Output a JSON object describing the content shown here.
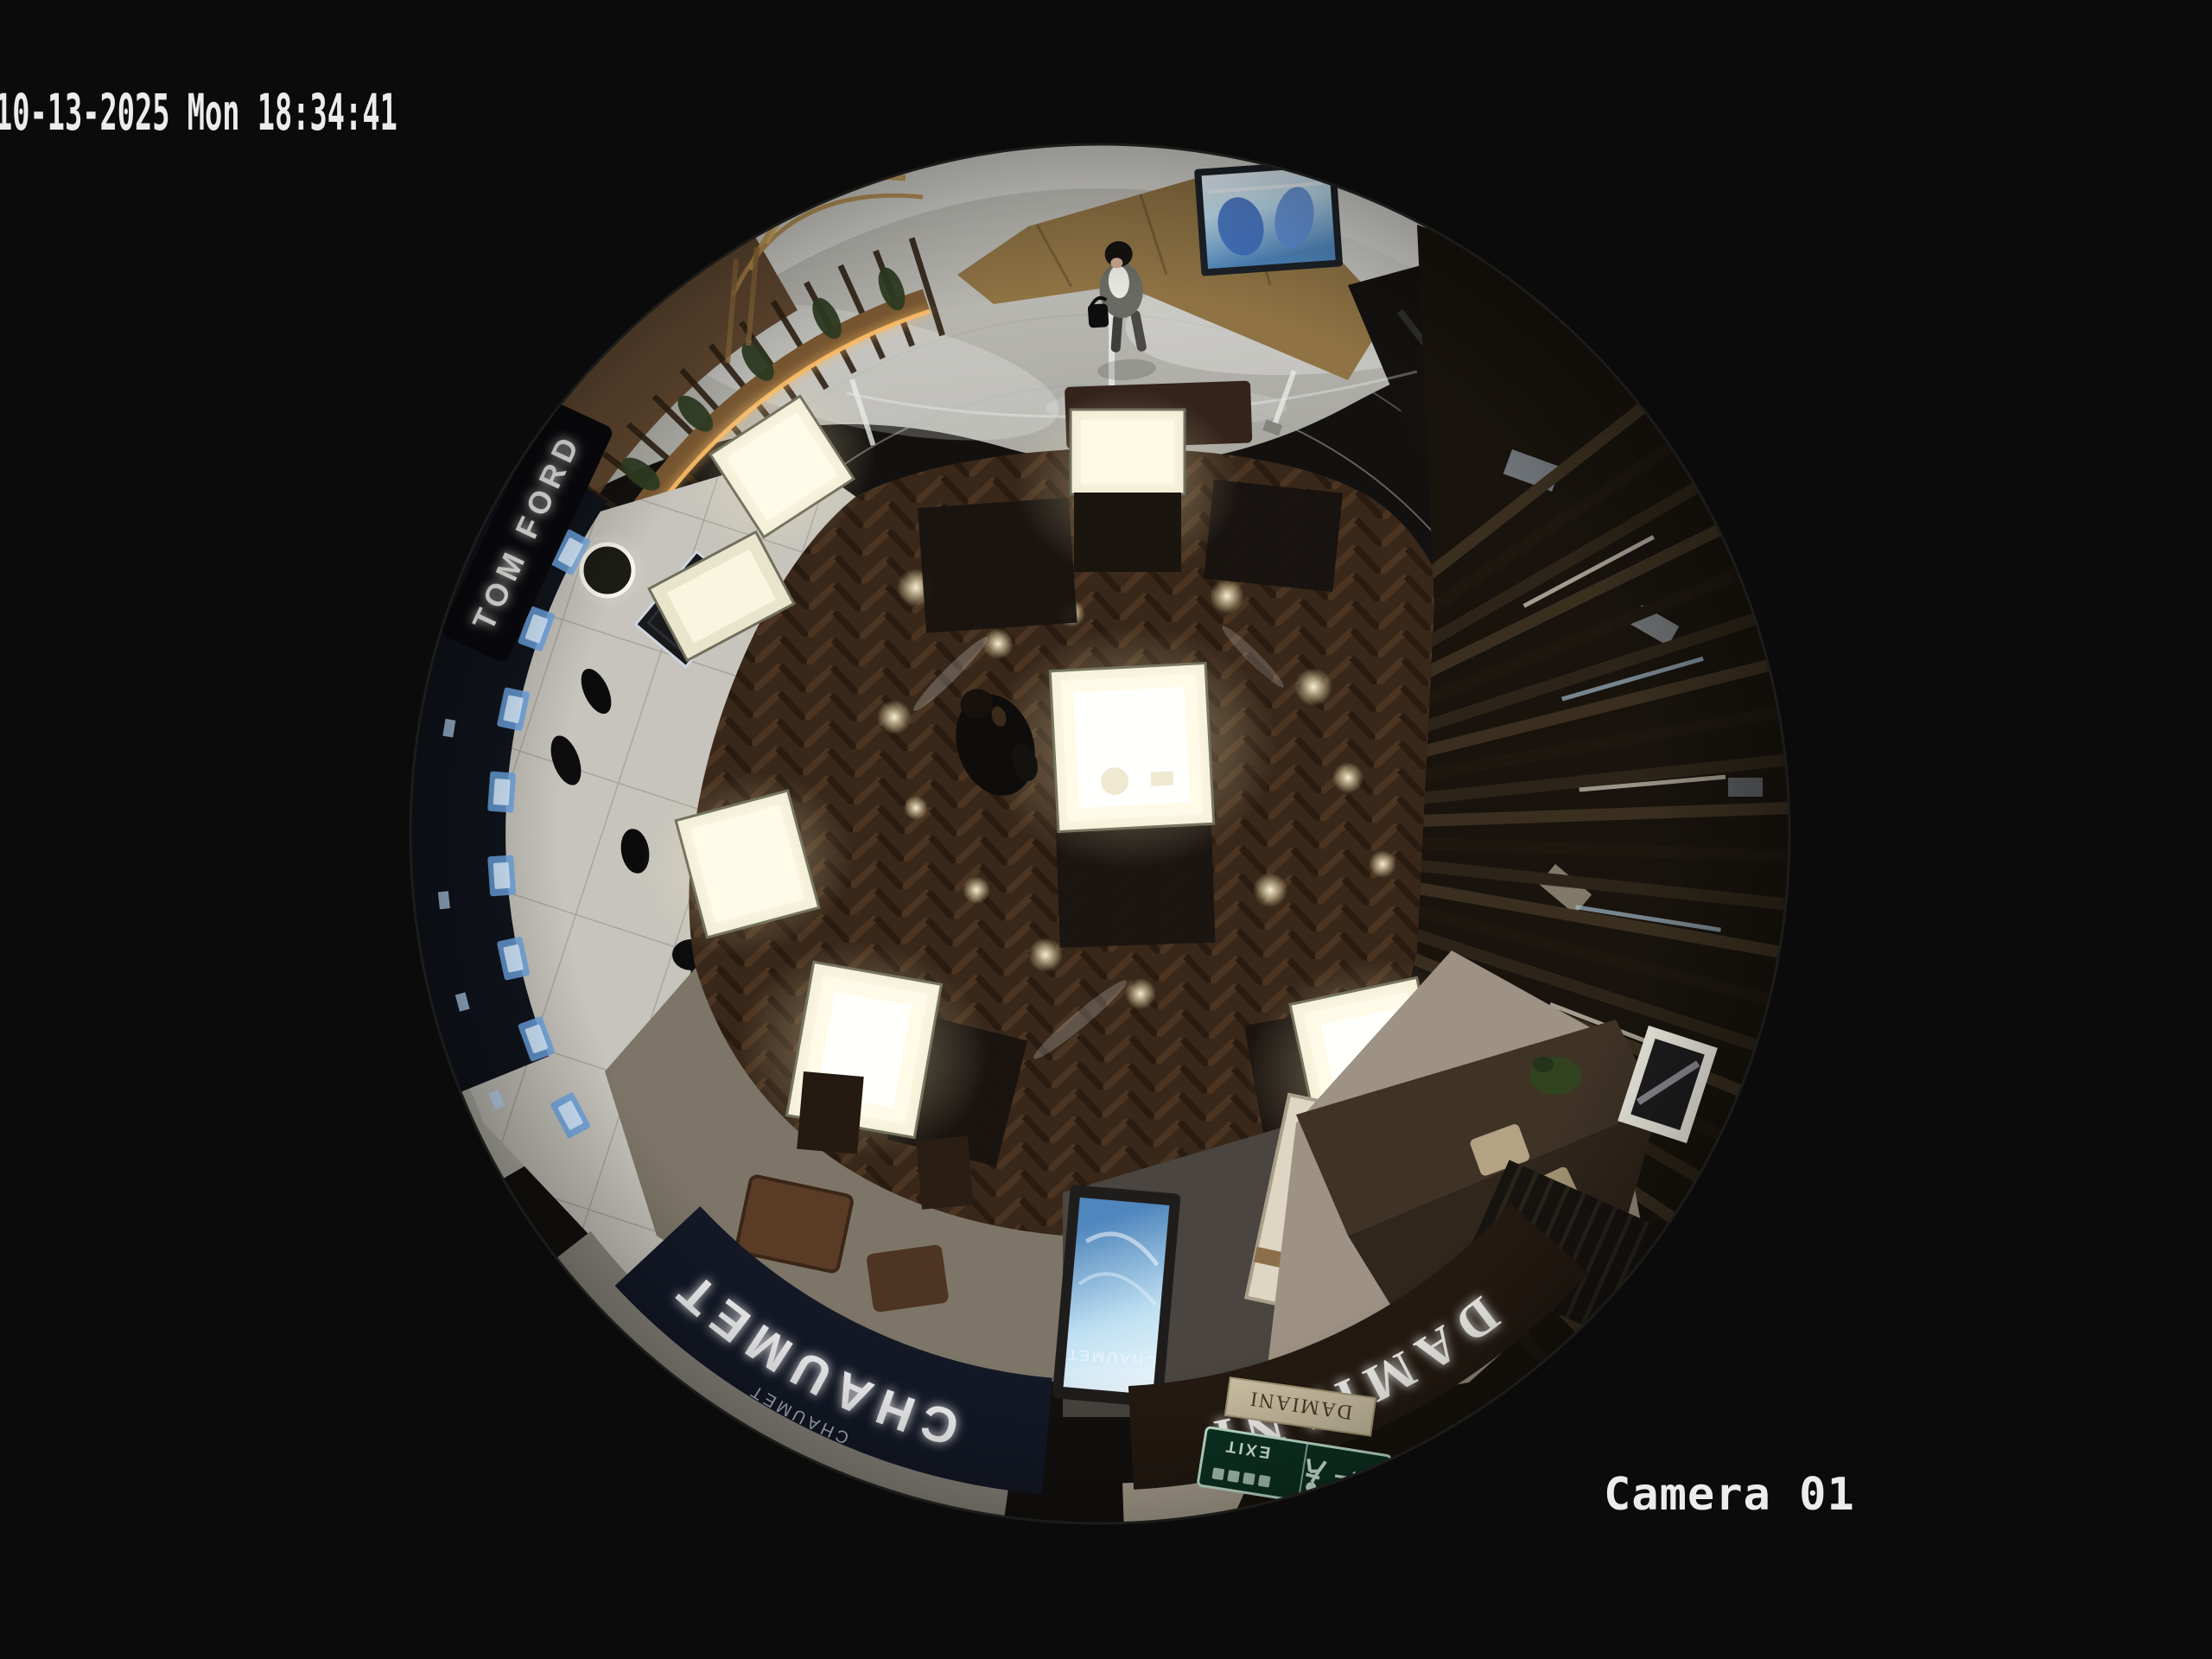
{
  "osd": {
    "timestamp": "10-13-2025 Mon 18:34:41",
    "camera_label": "Camera 01",
    "text_color": "#ECECEC"
  },
  "signs": {
    "chaumet_fascia": "CHAUMET",
    "chaumet_boutique_small": "CHAUMET",
    "chaumet_poster": "CHAUMET",
    "damiani_fascia": "DAMIANI",
    "damiani_placard": "DAMIANI",
    "tom_ford": "TOM FORD",
    "tf_monogram": "TF",
    "exit_label": "EXIT",
    "exit_arrow": "←"
  },
  "palette": {
    "background": "#0B0B0B",
    "osd_text": "#ECECEC",
    "marble_corridor": "#B9B8B2",
    "store_tile": "#C6C4BC",
    "wood_floor": "#39281A",
    "chaumet_fascia_navy": "#141927",
    "damiani_fascia_brown": "#241A12",
    "slat_partition": "#1D1710",
    "exit_green": "#0C3423",
    "poster_blue": "#5D93C8",
    "counter_blue_glow": "#8FC0FF",
    "case_glow": "#FFFBE8",
    "gold_wall": "#8F7344",
    "led_strip": "#FFBE66"
  }
}
